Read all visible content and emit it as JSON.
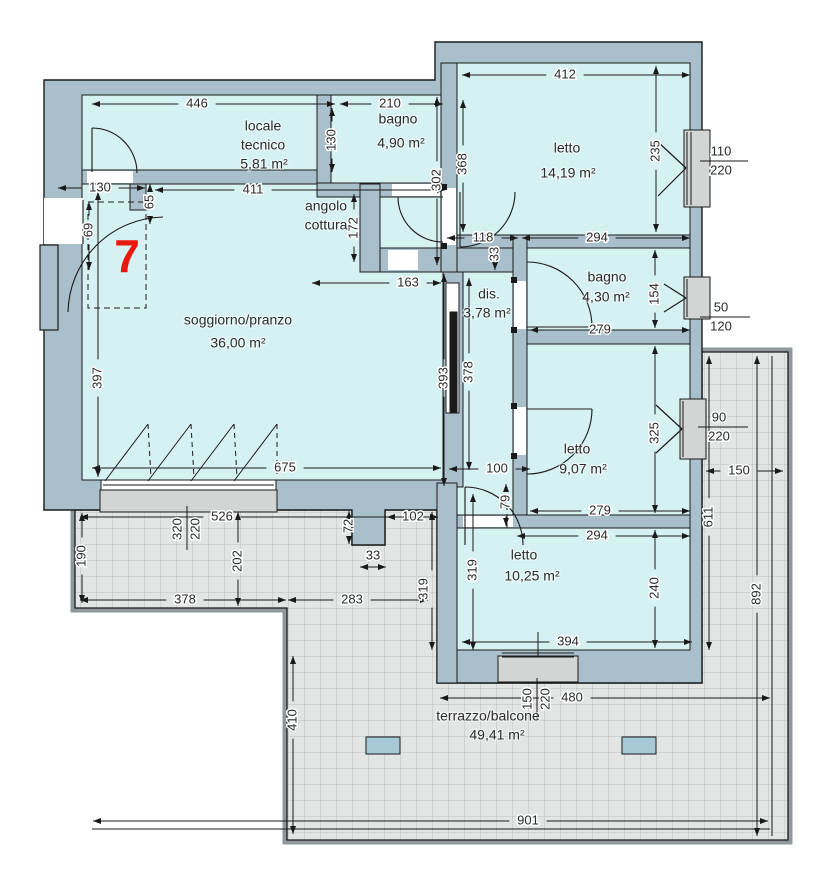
{
  "plan": {
    "unit_number": "7",
    "type_label": "floor-plan",
    "rooms": [
      {
        "name": "locale tecnico",
        "area": "5,81 m²",
        "labels": [
          [
            "locale",
            263,
            127
          ],
          [
            "tecnico",
            263,
            146
          ],
          [
            "5,81 m²",
            264,
            165
          ]
        ]
      },
      {
        "name": "bagno",
        "area": "4,90 m²",
        "labels": [
          [
            "bagno",
            398,
            120
          ],
          [
            "4,90 m²",
            401,
            144
          ]
        ]
      },
      {
        "name": "letto",
        "area": "14,19 m²",
        "labels": [
          [
            "letto",
            567,
            149
          ],
          [
            "14,19 m²",
            568,
            174
          ]
        ]
      },
      {
        "name": "angolo cottura",
        "area": "",
        "labels": [
          [
            "angolo",
            326,
            207
          ],
          [
            "cottura",
            326,
            226
          ]
        ]
      },
      {
        "name": "soggiorno/pranzo",
        "area": "36,00 m²",
        "labels": [
          [
            "soggiorno/pranzo",
            238,
            321
          ],
          [
            "36,00 m²",
            238,
            344
          ]
        ]
      },
      {
        "name": "dis.",
        "area": "3,78 m²",
        "labels": [
          [
            "dis.",
            489,
            295
          ],
          [
            "3,78 m²",
            487,
            314
          ]
        ]
      },
      {
        "name": "bagno",
        "area": "4,30 m²",
        "labels": [
          [
            "bagno",
            607,
            278
          ],
          [
            "4,30 m²",
            606,
            298
          ]
        ]
      },
      {
        "name": "letto",
        "area": "9,07 m²",
        "labels": [
          [
            "letto",
            577,
            450
          ],
          [
            "9,07 m²",
            583,
            470
          ]
        ]
      },
      {
        "name": "letto",
        "area": "10,25 m²",
        "labels": [
          [
            "letto",
            524,
            556
          ],
          [
            "10,25 m²",
            532,
            577
          ]
        ]
      },
      {
        "name": "terrazzo/balcone",
        "area": "49,41 m²",
        "labels": [
          [
            "terrazzo/balcone",
            488,
            717
          ],
          [
            "49,41 m²",
            497,
            736
          ]
        ]
      }
    ],
    "dimensions": [
      {
        "t": "446",
        "x": 197,
        "y": 104,
        "r": "h",
        "l": [
          92,
          104,
          335,
          104
        ]
      },
      {
        "t": "210",
        "x": 390,
        "y": 104,
        "r": "h",
        "l": [
          340,
          104,
          443,
          104
        ]
      },
      {
        "t": "412",
        "x": 565,
        "y": 75,
        "r": "h",
        "l": [
          462,
          75,
          690,
          75
        ]
      },
      {
        "t": "130",
        "x": 100,
        "y": 188,
        "r": "h",
        "l": [
          58,
          188,
          145,
          188
        ]
      },
      {
        "t": "411",
        "x": 253,
        "y": 190,
        "r": "h",
        "l": [
          155,
          190,
          445,
          190
        ]
      },
      {
        "t": "118",
        "x": 483,
        "y": 238,
        "r": "h",
        "l": [
          447,
          238,
          518,
          238
        ]
      },
      {
        "t": "294",
        "x": 597,
        "y": 238,
        "r": "h",
        "l": [
          522,
          238,
          690,
          238
        ]
      },
      {
        "t": "163",
        "x": 408,
        "y": 283,
        "r": "h",
        "l": [
          312,
          283,
          441,
          283
        ]
      },
      {
        "t": "279",
        "x": 600,
        "y": 330,
        "r": "h",
        "l": [
          530,
          330,
          690,
          330
        ]
      },
      {
        "t": "675",
        "x": 285,
        "y": 468,
        "r": "h",
        "l": [
          92,
          468,
          441,
          468
        ]
      },
      {
        "t": "100",
        "x": 497,
        "y": 469,
        "r": "h",
        "l": [
          449,
          469,
          530,
          469
        ]
      },
      {
        "t": "279",
        "x": 600,
        "y": 511,
        "r": "h",
        "l": [
          530,
          511,
          690,
          511
        ]
      },
      {
        "t": "294",
        "x": 597,
        "y": 536,
        "r": "h",
        "l": [
          517,
          536,
          690,
          536
        ]
      },
      {
        "t": "394",
        "x": 568,
        "y": 642,
        "r": "h",
        "l": [
          462,
          642,
          692,
          642
        ]
      },
      {
        "t": "526",
        "x": 222,
        "y": 517,
        "r": "h",
        "l": [
          80,
          517,
          438,
          517
        ]
      },
      {
        "t": "102",
        "x": 413,
        "y": 517,
        "r": "h",
        "l": [
          387,
          517,
          438,
          517
        ]
      },
      {
        "t": "33",
        "x": 373,
        "y": 556,
        "r": "h",
        "l": [
          360,
          567,
          386,
          567
        ]
      },
      {
        "t": "378",
        "x": 185,
        "y": 600,
        "r": "h",
        "l": [
          80,
          600,
          286,
          600
        ]
      },
      {
        "t": "283",
        "x": 352,
        "y": 600,
        "r": "h",
        "l": [
          288,
          600,
          428,
          600
        ]
      },
      {
        "t": "150",
        "x": 739,
        "y": 471,
        "r": "h",
        "l": [
          706,
          471,
          783,
          471
        ]
      },
      {
        "t": "480",
        "x": 572,
        "y": 698,
        "r": "h",
        "l": [
          440,
          698,
          770,
          698
        ]
      },
      {
        "t": "901",
        "x": 528,
        "y": 821,
        "r": "h",
        "l": [
          93,
          821,
          768,
          821
        ]
      },
      {
        "t": "110",
        "x": 721,
        "y": 152,
        "r": "h",
        "l": null
      },
      {
        "t": "220",
        "x": 721,
        "y": 171,
        "r": "h",
        "l": null
      },
      {
        "t": "50",
        "x": 721,
        "y": 308,
        "r": "h",
        "l": null
      },
      {
        "t": "120",
        "x": 721,
        "y": 327,
        "r": "h",
        "l": null
      },
      {
        "t": "90",
        "x": 719,
        "y": 418,
        "r": "h",
        "l": null
      },
      {
        "t": "220",
        "x": 719,
        "y": 437,
        "r": "h",
        "l": null
      },
      {
        "t": "130",
        "x": 332,
        "y": 140,
        "r": "v",
        "l": [
          332,
          108,
          332,
          172
        ]
      },
      {
        "t": "368",
        "x": 463,
        "y": 164,
        "r": "v",
        "l": [
          463,
          100,
          463,
          232
        ]
      },
      {
        "t": "302",
        "x": 437,
        "y": 180,
        "r": "v",
        "l": [
          437,
          97,
          437,
          265
        ]
      },
      {
        "t": "235",
        "x": 656,
        "y": 151,
        "r": "v",
        "l": [
          656,
          66,
          656,
          232
        ]
      },
      {
        "t": "65",
        "x": 150,
        "y": 202,
        "r": "v",
        "l": [
          150,
          184,
          150,
          224
        ]
      },
      {
        "t": "69",
        "x": 89,
        "y": 230,
        "r": "v",
        "l": [
          89,
          202,
          89,
          270
        ]
      },
      {
        "t": "172",
        "x": 354,
        "y": 228,
        "r": "v",
        "l": [
          354,
          194,
          354,
          262
        ]
      },
      {
        "t": "33",
        "x": 495,
        "y": 254,
        "r": "v",
        "l": [
          495,
          240,
          495,
          270
        ]
      },
      {
        "t": "154",
        "x": 655,
        "y": 294,
        "r": "v",
        "l": [
          655,
          250,
          655,
          328
        ]
      },
      {
        "t": "397",
        "x": 98,
        "y": 378,
        "r": "v",
        "l": [
          98,
          192,
          98,
          477
        ]
      },
      {
        "t": "393",
        "x": 444,
        "y": 378,
        "r": "v",
        "l": [
          444,
          274,
          444,
          486
        ]
      },
      {
        "t": "378",
        "x": 469,
        "y": 372,
        "r": "v",
        "l": [
          469,
          278,
          469,
          470
        ]
      },
      {
        "t": "325",
        "x": 655,
        "y": 433,
        "r": "v",
        "l": [
          655,
          346,
          655,
          513
        ]
      },
      {
        "t": "79",
        "x": 506,
        "y": 502,
        "r": "v",
        "l": [
          506,
          484,
          506,
          526
        ]
      },
      {
        "t": "319",
        "x": 473,
        "y": 570,
        "r": "v",
        "l": [
          473,
          494,
          473,
          650
        ]
      },
      {
        "t": "240",
        "x": 655,
        "y": 588,
        "r": "v",
        "l": [
          655,
          530,
          655,
          648
        ]
      },
      {
        "t": "611",
        "x": 709,
        "y": 517,
        "r": "v",
        "l": [
          709,
          356,
          709,
          650
        ]
      },
      {
        "t": "892",
        "x": 757,
        "y": 594,
        "r": "v",
        "l": [
          757,
          356,
          757,
          836
        ]
      },
      {
        "t": "72",
        "x": 349,
        "y": 526,
        "r": "v",
        "l": [
          349,
          511,
          349,
          544
        ]
      },
      {
        "t": "202",
        "x": 238,
        "y": 561,
        "r": "v",
        "l": [
          238,
          512,
          238,
          606
        ]
      },
      {
        "t": "190",
        "x": 82,
        "y": 556,
        "r": "v",
        "l": [
          82,
          513,
          82,
          603
        ]
      },
      {
        "t": "319",
        "x": 424,
        "y": 589,
        "r": "v",
        "l": [
          432,
          512,
          432,
          650
        ]
      },
      {
        "t": "410",
        "x": 293,
        "y": 720,
        "r": "v",
        "l": [
          293,
          656,
          293,
          834
        ]
      },
      {
        "t": "320",
        "x": 178,
        "y": 529,
        "r": "v",
        "l": null
      },
      {
        "t": "220",
        "x": 196,
        "y": 529,
        "r": "v",
        "l": null
      },
      {
        "t": "150",
        "x": 528,
        "y": 699,
        "r": "v",
        "l": null
      },
      {
        "t": "220",
        "x": 546,
        "y": 699,
        "r": "v",
        "l": null
      }
    ]
  },
  "colors": {
    "wall": "#a9c0cc",
    "room": "#d6f1f2",
    "terrace": "#e3e5e5",
    "grid": "#babfbf",
    "parapet": "#8f989b",
    "sill": "#d3d4d4",
    "skylight": "#a7c9d7",
    "accent_red": "#e8190f",
    "line": "#1a1a1a",
    "dim_text": "#2b2b2b"
  }
}
